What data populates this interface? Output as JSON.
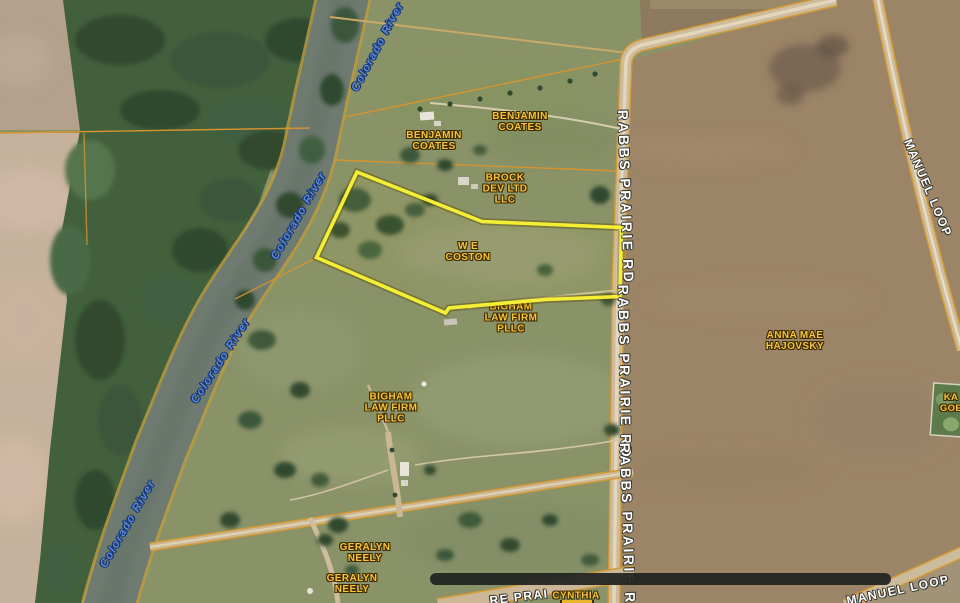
{
  "map": {
    "type": "satellite-parcel-map",
    "labels": {
      "river": {
        "text": "Colorado River"
      },
      "benjamin_coates": {
        "lines": [
          "BENJAMIN",
          "COATES"
        ]
      },
      "brock_dev": {
        "lines": [
          "BROCK",
          "DEV LTD",
          "LLC"
        ]
      },
      "we_coston": {
        "lines": [
          "W E",
          "COSTON"
        ]
      },
      "bigham_law_firm": {
        "lines": [
          "BIGHAM",
          "LAW FIRM",
          "PLLC"
        ]
      },
      "anna_mae_hajovsky": {
        "lines": [
          "ANNA MAE",
          "HAJOVSKY"
        ]
      },
      "geralyn_neely": {
        "lines": [
          "GERALYN",
          "NEELY"
        ]
      },
      "cynthia": {
        "text": "CYNTHIA"
      },
      "partial_right_edge": {
        "lines": [
          "KA",
          "GOE"
        ]
      }
    },
    "roads": {
      "rabbs_prairie": "RABBS PRAIRIE RD",
      "manuel_loop": "MANUEL LOOP",
      "bottom_fragment": "RE PRAI"
    },
    "colors": {
      "parcel_highlight": "#f4ef35",
      "owner_label": "#f7c437",
      "road_label": "#ffffff",
      "river_label": "#5b87d6",
      "boundary_line": "#d6942f",
      "river_water": "#6f7b70",
      "field_brown": "#9c8467",
      "pasture_green": "#8a9268"
    }
  }
}
